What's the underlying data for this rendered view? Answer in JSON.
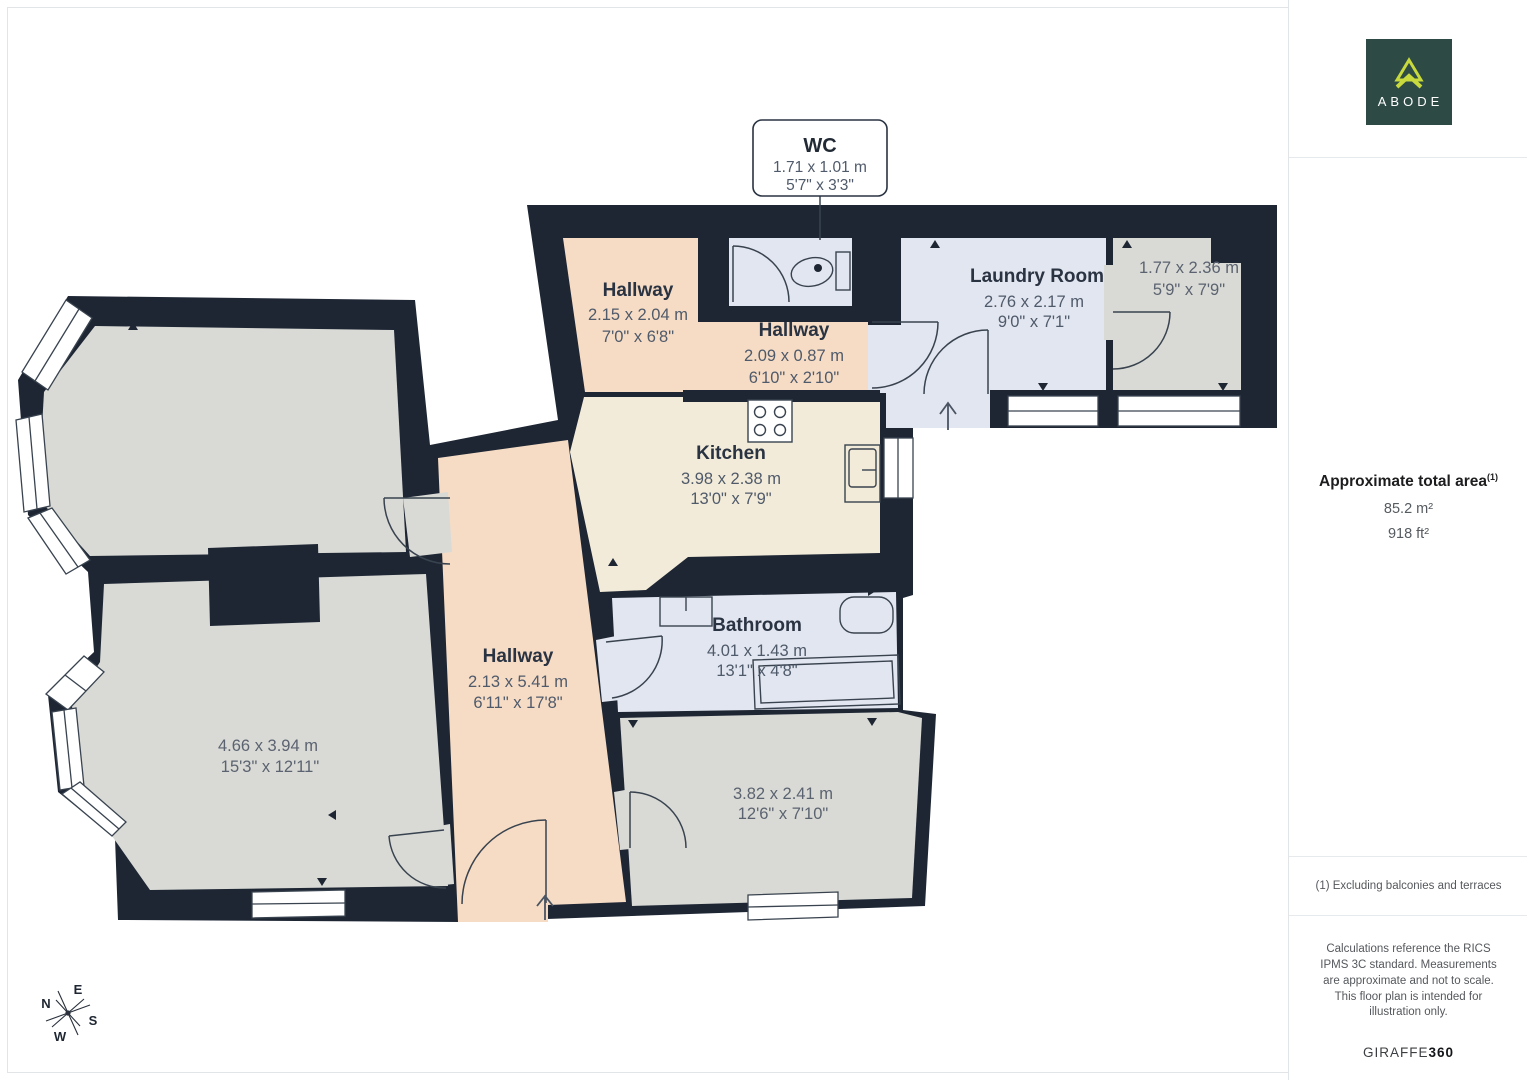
{
  "plan": {
    "callout": {
      "name": "WC",
      "metric": "1.71 x 1.01 m",
      "imperial": "5'7\" x 3'3\""
    },
    "rooms": {
      "hallway_top": {
        "name": "Hallway",
        "metric": "2.15 x 2.04 m",
        "imperial": "7'0\" x 6'8\""
      },
      "hallway_strip": {
        "name": "Hallway",
        "metric": "2.09 x 0.87 m",
        "imperial": "6'10\" x 2'10\""
      },
      "laundry": {
        "name": "Laundry Room",
        "metric": "2.76 x 2.17 m",
        "imperial": "9'0\" x 7'1\""
      },
      "store": {
        "metric": "1.77 x 2.36 m",
        "imperial": "5'9\" x 7'9\""
      },
      "kitchen": {
        "name": "Kitchen",
        "metric": "3.98 x 2.38 m",
        "imperial": "13'0\" x 7'9\""
      },
      "bathroom": {
        "name": "Bathroom",
        "metric": "4.01 x 1.43 m",
        "imperial": "13'1\" x 4'8\""
      },
      "hallway_main": {
        "name": "Hallway",
        "metric": "2.13 x 5.41 m",
        "imperial": "6'11\" x 17'8\""
      },
      "room_left": {
        "metric": "4.66 x 3.94 m",
        "imperial": "15'3\" x 12'11\""
      },
      "room_bottom": {
        "metric": "3.82 x 2.41 m",
        "imperial": "12'6\" x 7'10\""
      }
    },
    "compass": {
      "n": "N",
      "e": "E",
      "s": "S",
      "w": "W"
    }
  },
  "sidebar": {
    "logo_text": "ABODE",
    "area": {
      "title": "Approximate total area",
      "footnote_marker": "(1)",
      "metric": "85.2 m²",
      "imperial": "918 ft²"
    },
    "footnote": "(1) Excluding balconies and terraces",
    "disclaimer": "Calculations reference the RICS IPMS 3C standard. Measurements are approximate and not to scale. This floor plan is intended for illustration only.",
    "brand_name": "GIRAFFE",
    "brand_suffix": "360"
  },
  "colors": {
    "wall": "#1e2634",
    "hallway_fill": "#f6dcc5",
    "kitchen_fill": "#f3ebd9",
    "wet_fill": "#e2e6f0",
    "room_fill": "#d9dad6",
    "logo_bg": "#2d4a45",
    "logo_accent": "#c7d93c"
  }
}
